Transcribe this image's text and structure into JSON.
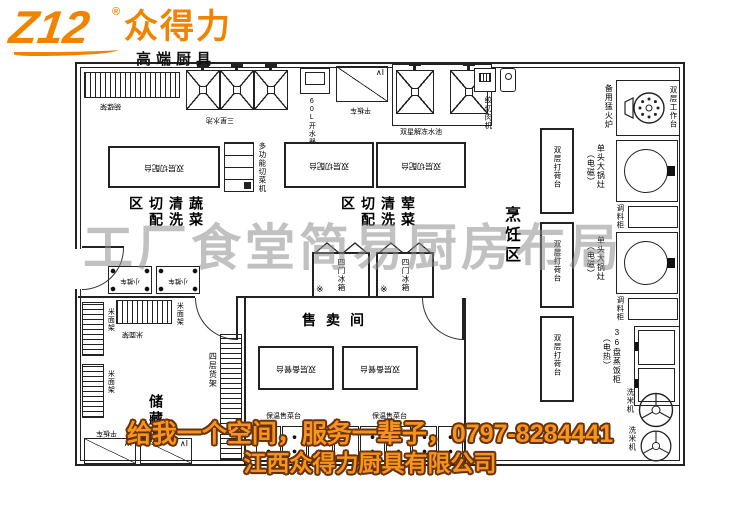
{
  "logo": {
    "mark": "Z12",
    "reg": "®",
    "name": "众得力",
    "tagline": "高端厨具"
  },
  "watermark": "工厂食堂简易厨房布局",
  "footer": {
    "slogan": "给我一个空间，服务一辈子，0797-8284441",
    "company": "江西众得力厨具有限公司"
  },
  "areas": {
    "veg": "蔬菜清洗切配区",
    "meat": "荤菜清洗切配区",
    "cook": "烹饪区",
    "sell": "售卖间",
    "store": "储藏间"
  },
  "equipment": {
    "bowl_rack": "碗碟架",
    "sink_3star": "三星水池",
    "water_boiler": "60L开水器",
    "flat_cart": "平板车",
    "cart_mark": "∧I",
    "thaw_sink": "双星解冻水池",
    "meat_grinder": "绞切肉机",
    "cut_table": "双层切配台",
    "veg_cutter": "多功能切菜机",
    "fridge": "四门冰箱",
    "snow_mark": "※",
    "prep_table": "双层备餐台",
    "warm_counter": "保温售菜台",
    "rice_flour_rack": "米面架",
    "shelf_4layer": "四层货架",
    "trolley": "小推车",
    "service_table": "双层打荷台",
    "backup_burner": "备用猛火炉",
    "work_table": "双层工作台",
    "wok_stove": "单头大锅灶",
    "wok_note": "（电磁）",
    "spice_cabinet": "调料柜",
    "rice_steamer": "36盘蒸饭柜",
    "steamer_note": "（电热）",
    "rice_washer": "洗米机"
  },
  "colors": {
    "brand_orange": "#F08300",
    "outline_brown": "#6A3208",
    "line": "#222222",
    "watermark_gray": "#8F8F8F"
  }
}
